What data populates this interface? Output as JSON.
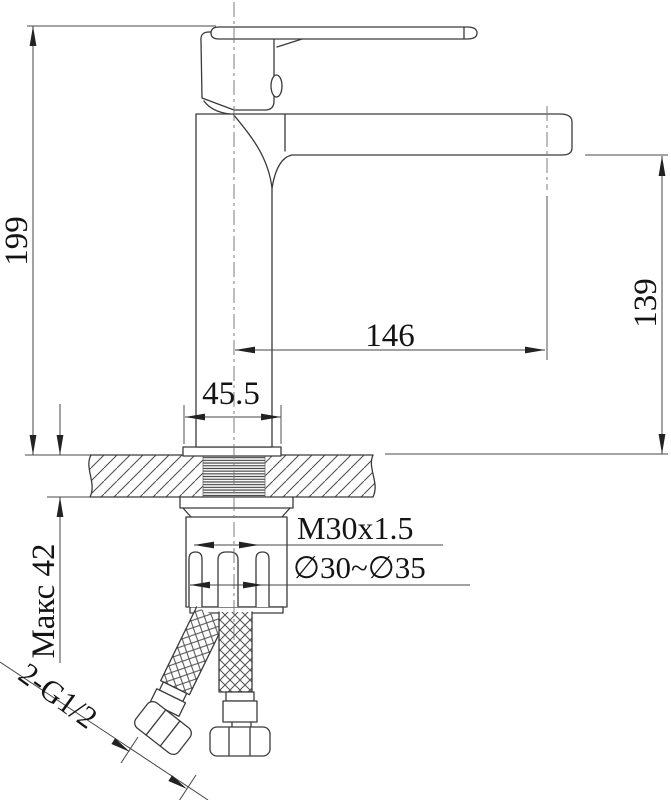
{
  "drawing": {
    "subject": "single-lever basin mixer faucet - dimensional side view with deck cross-section and supply hoses",
    "colors": {
      "background": "#ffffff",
      "object_line": "#3a3a3a",
      "dimension_line": "#454545",
      "text": "#141414"
    },
    "labels": {
      "total_height": "199",
      "spout_reach": "146",
      "outlet_height": "139",
      "base_width": "45.5",
      "max_deck": "Макс 42",
      "thread": "M30x1.5",
      "hole_range": "∅30~∅35",
      "hoses": "2-G1/2"
    }
  }
}
